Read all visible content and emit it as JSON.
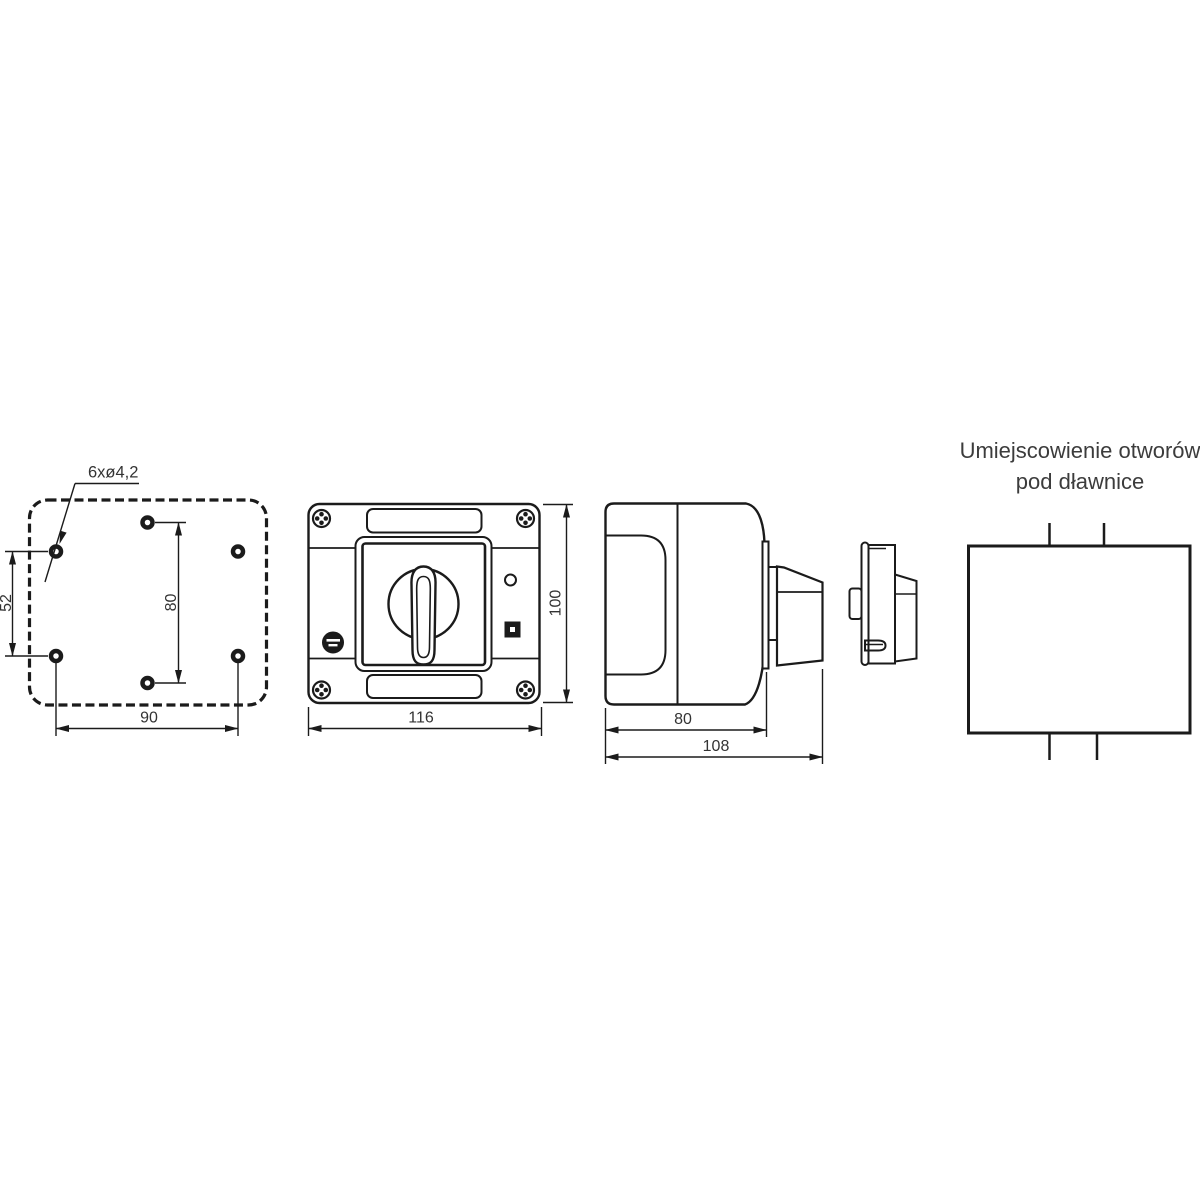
{
  "drawing_title": {
    "line1": "Umiejscowienie otworów",
    "line2": "pod dławnice"
  },
  "views": {
    "mounting_plate": {
      "hole_label": "6xø4,2",
      "dim_left_vertical": "52",
      "dim_inner_vertical": "80",
      "dim_bottom_horizontal": "90"
    },
    "front": {
      "dim_width": "116",
      "dim_height": "100"
    },
    "side": {
      "dim_body_depth": "80",
      "dim_total_depth": "108"
    }
  },
  "colors": {
    "line": "#1b1b1b",
    "dimension_text": "#333333",
    "title_text": "#3c3c3c",
    "background": "#ffffff"
  }
}
